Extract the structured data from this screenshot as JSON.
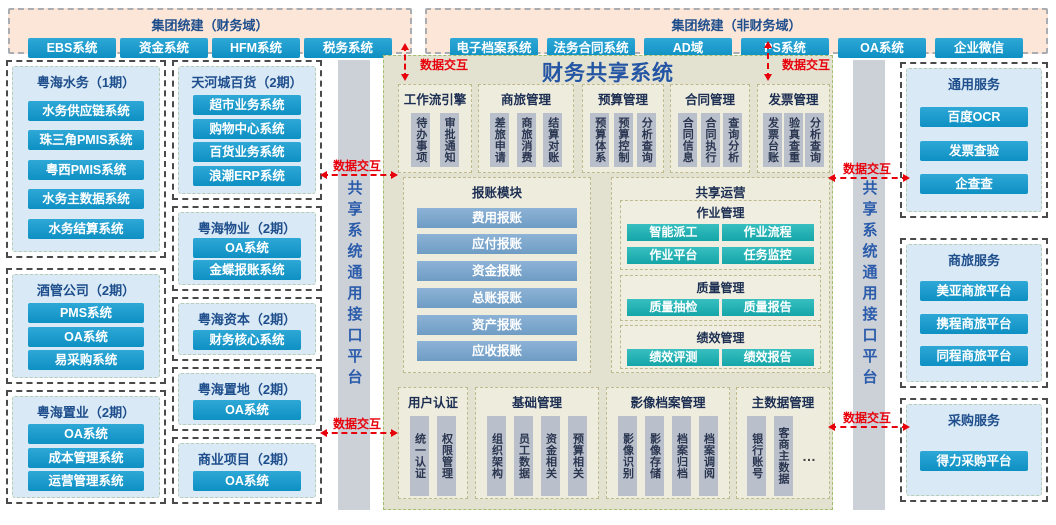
{
  "labels": {
    "data_exchange": "数据交互"
  },
  "interface_bar": {
    "label": "共享系统通用接口平台"
  },
  "top_left": {
    "title": "集团统建（财务域）",
    "systems": [
      "EBS系统",
      "资金系统",
      "HFM系统",
      "税务系统"
    ]
  },
  "top_right": {
    "title": "集团统建（非财务域）",
    "systems": [
      "电子档案系统",
      "法务合同系统",
      "AD域",
      "PS系统",
      "OA系统",
      "企业微信"
    ]
  },
  "left_col1": [
    {
      "title": "粤海水务（1期）",
      "systems": [
        "水务供应链系统",
        "珠三角PMIS系统",
        "粤西PMIS系统",
        "水务主数据系统",
        "水务结算系统"
      ]
    },
    {
      "title": "酒管公司（2期）",
      "systems": [
        "PMS系统",
        "OA系统",
        "易采购系统"
      ]
    },
    {
      "title": "粤海置业（2期）",
      "systems": [
        "OA系统",
        "成本管理系统",
        "运营管理系统"
      ]
    }
  ],
  "left_col2": [
    {
      "title": "天河城百货（2期）",
      "systems": [
        "超市业务系统",
        "购物中心系统",
        "百货业务系统",
        "浪潮ERP系统"
      ]
    },
    {
      "title": "粤海物业（2期）",
      "systems": [
        "OA系统",
        "金蝶报账系统"
      ]
    },
    {
      "title": "粤海资本（2期）",
      "systems": [
        "财务核心系统"
      ]
    },
    {
      "title": "粤海置地（2期）",
      "systems": [
        "OA系统"
      ]
    },
    {
      "title": "商业项目（2期）",
      "systems": [
        "OA系统"
      ]
    }
  ],
  "right_col": [
    {
      "title": "通用服务",
      "systems": [
        "百度OCR",
        "发票查验",
        "企查查"
      ]
    },
    {
      "title": "商旅服务",
      "systems": [
        "美亚商旅平台",
        "携程商旅平台",
        "同程商旅平台"
      ]
    },
    {
      "title": "采购服务",
      "systems": [
        "得力采购平台"
      ]
    }
  ],
  "center": {
    "title": "财务共享系统",
    "top_modules": [
      {
        "title": "工作流引擎",
        "items": [
          "待办事项",
          "审批通知"
        ]
      },
      {
        "title": "商旅管理",
        "items": [
          "差旅申请",
          "商旅消费",
          "结算对账"
        ]
      },
      {
        "title": "预算管理",
        "items": [
          "预算体系",
          "预算控制",
          "分析查询"
        ]
      },
      {
        "title": "合同管理",
        "items": [
          "合同信息",
          "合同执行",
          "查询分析"
        ]
      },
      {
        "title": "发票管理",
        "items": [
          "发票台账",
          "验真查重",
          "分析查询"
        ]
      }
    ],
    "reimbursement": {
      "title": "报账模块",
      "items": [
        "费用报账",
        "应付报账",
        "资金报账",
        "总账报账",
        "资产报账",
        "应收报账"
      ]
    },
    "shared_ops": {
      "title": "共享运营",
      "groups": [
        {
          "title": "作业管理",
          "items": [
            "智能派工",
            "作业流程",
            "作业平台",
            "任务监控"
          ]
        },
        {
          "title": "质量管理",
          "items": [
            "质量抽检",
            "质量报告"
          ]
        },
        {
          "title": "绩效管理",
          "items": [
            "绩效评测",
            "绩效报告"
          ]
        }
      ]
    },
    "bottom_modules": [
      {
        "title": "用户认证",
        "items": [
          "统一认证",
          "权限管理"
        ]
      },
      {
        "title": "基础管理",
        "items": [
          "组织架构",
          "员工数据",
          "资金相关",
          "预算相关"
        ]
      },
      {
        "title": "影像档案管理",
        "items": [
          "影像识别",
          "影像存储",
          "档案归档",
          "档案调阅"
        ]
      },
      {
        "title": "主数据管理",
        "items": [
          "银行账号",
          "客商主数据",
          "…"
        ]
      }
    ]
  }
}
